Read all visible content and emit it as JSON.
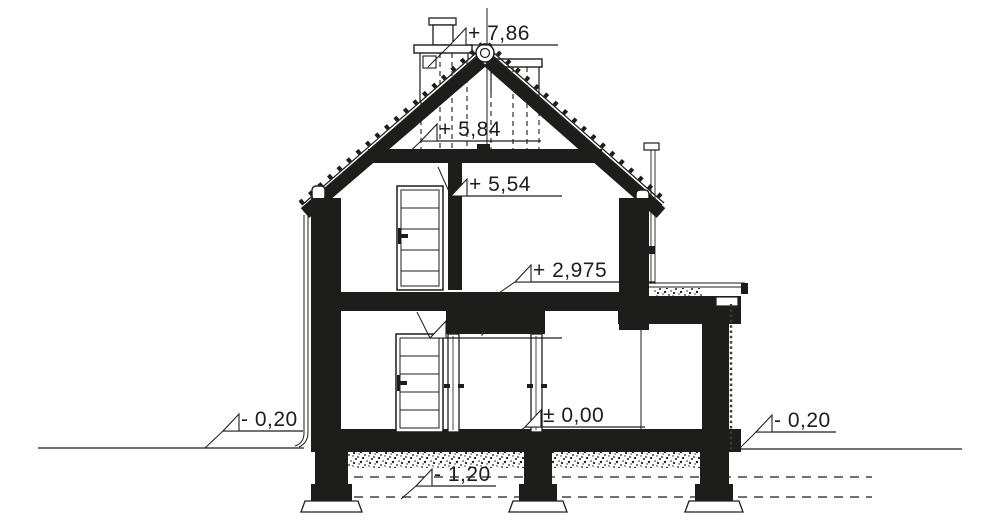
{
  "drawing": {
    "colors": {
      "ink": "#1d1d1b",
      "background": "#ffffff"
    },
    "levels": [
      {
        "name": "chimney-top",
        "text": "+ 7,86"
      },
      {
        "name": "attic-floor-top",
        "text": "+ 5,84"
      },
      {
        "name": "upper-ceiling",
        "text": "+ 5,54"
      },
      {
        "name": "floor-slab-top",
        "text": "+ 2,975"
      },
      {
        "name": "ground-ceiling",
        "text": "+ 2,645"
      },
      {
        "name": "ground-floor-level",
        "text": "± 0,00"
      },
      {
        "name": "terrain-left",
        "text": "- 0,20"
      },
      {
        "name": "terrain-right",
        "text": "- 0,20"
      },
      {
        "name": "foundation-level",
        "text": "- 1,20"
      }
    ]
  }
}
